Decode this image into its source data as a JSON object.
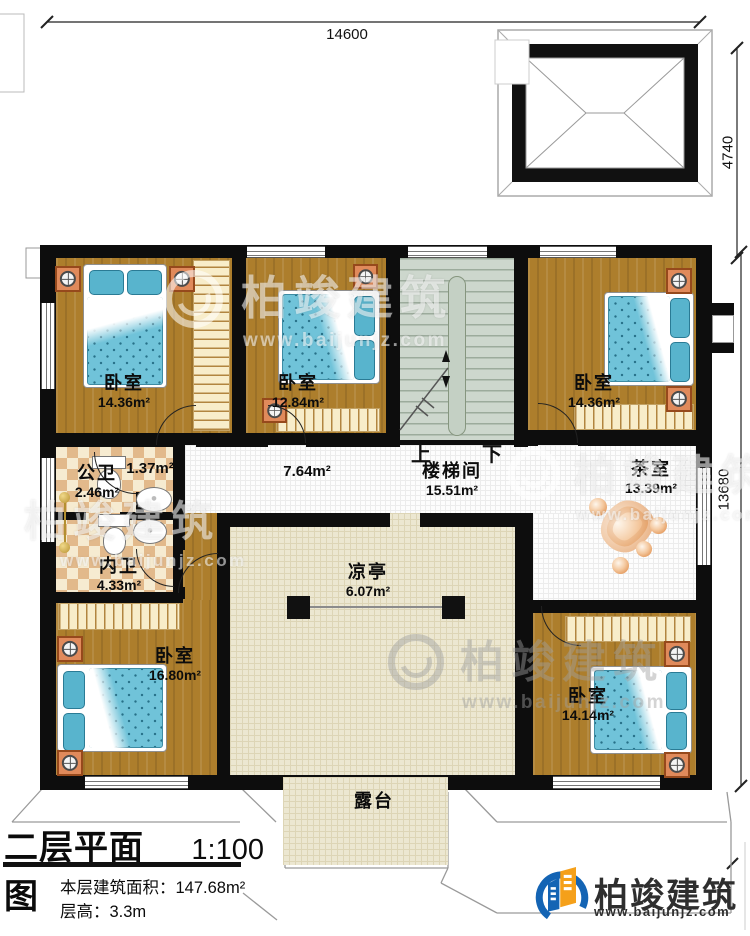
{
  "drawing": {
    "dim_top": "14600",
    "dim_tower": "4740",
    "dim_right": "13680"
  },
  "stairs": {
    "name": "楼梯间",
    "area": "15.51m²",
    "up": "上",
    "down": "下"
  },
  "rooms": {
    "bedroom_top_left": {
      "name": "卧室",
      "area": "14.36m²"
    },
    "bedroom_top_mid": {
      "name": "卧室",
      "area": "12.84m²"
    },
    "bedroom_top_right": {
      "name": "卧室",
      "area": "14.36m²"
    },
    "bedroom_bottom_left": {
      "name": "卧室",
      "area": "16.80m²"
    },
    "bedroom_bottom_right": {
      "name": "卧室",
      "area": "14.14m²"
    },
    "public_bath": {
      "name": "公卫",
      "area": "2.46m²"
    },
    "inner_bath": {
      "name": "内卫",
      "area": "4.33m²"
    },
    "closet_area": {
      "area": "1.37m²"
    },
    "hallway_area": {
      "area": "7.64m²"
    },
    "tea_room": {
      "name": "茶室",
      "area": "13.39m²"
    },
    "pavilion": {
      "name": "凉亭",
      "area": "6.07m²"
    },
    "terrace": {
      "name": "露台"
    }
  },
  "title_block": {
    "title": "二层平面图",
    "scale": "1:100",
    "floor_area": "本层建筑面积：147.68m²",
    "floor_height": "层高：3.3m"
  },
  "brand": {
    "name": "柏竣建筑",
    "website": "www.baijunjz.com"
  },
  "watermark": {
    "name": "柏竣建筑",
    "website": "www.baijunjz.com"
  },
  "colors": {
    "wall": "#0d0d0d",
    "wood": "#ad7e2c",
    "bed": "#70c3d9",
    "checker": "#e2b98b",
    "stair": "#cdd7cd",
    "pavilion": "#ece7d1",
    "stone": "#e59d61",
    "brand_blue": "#1464b4",
    "brand_orange": "#f5a01a"
  }
}
